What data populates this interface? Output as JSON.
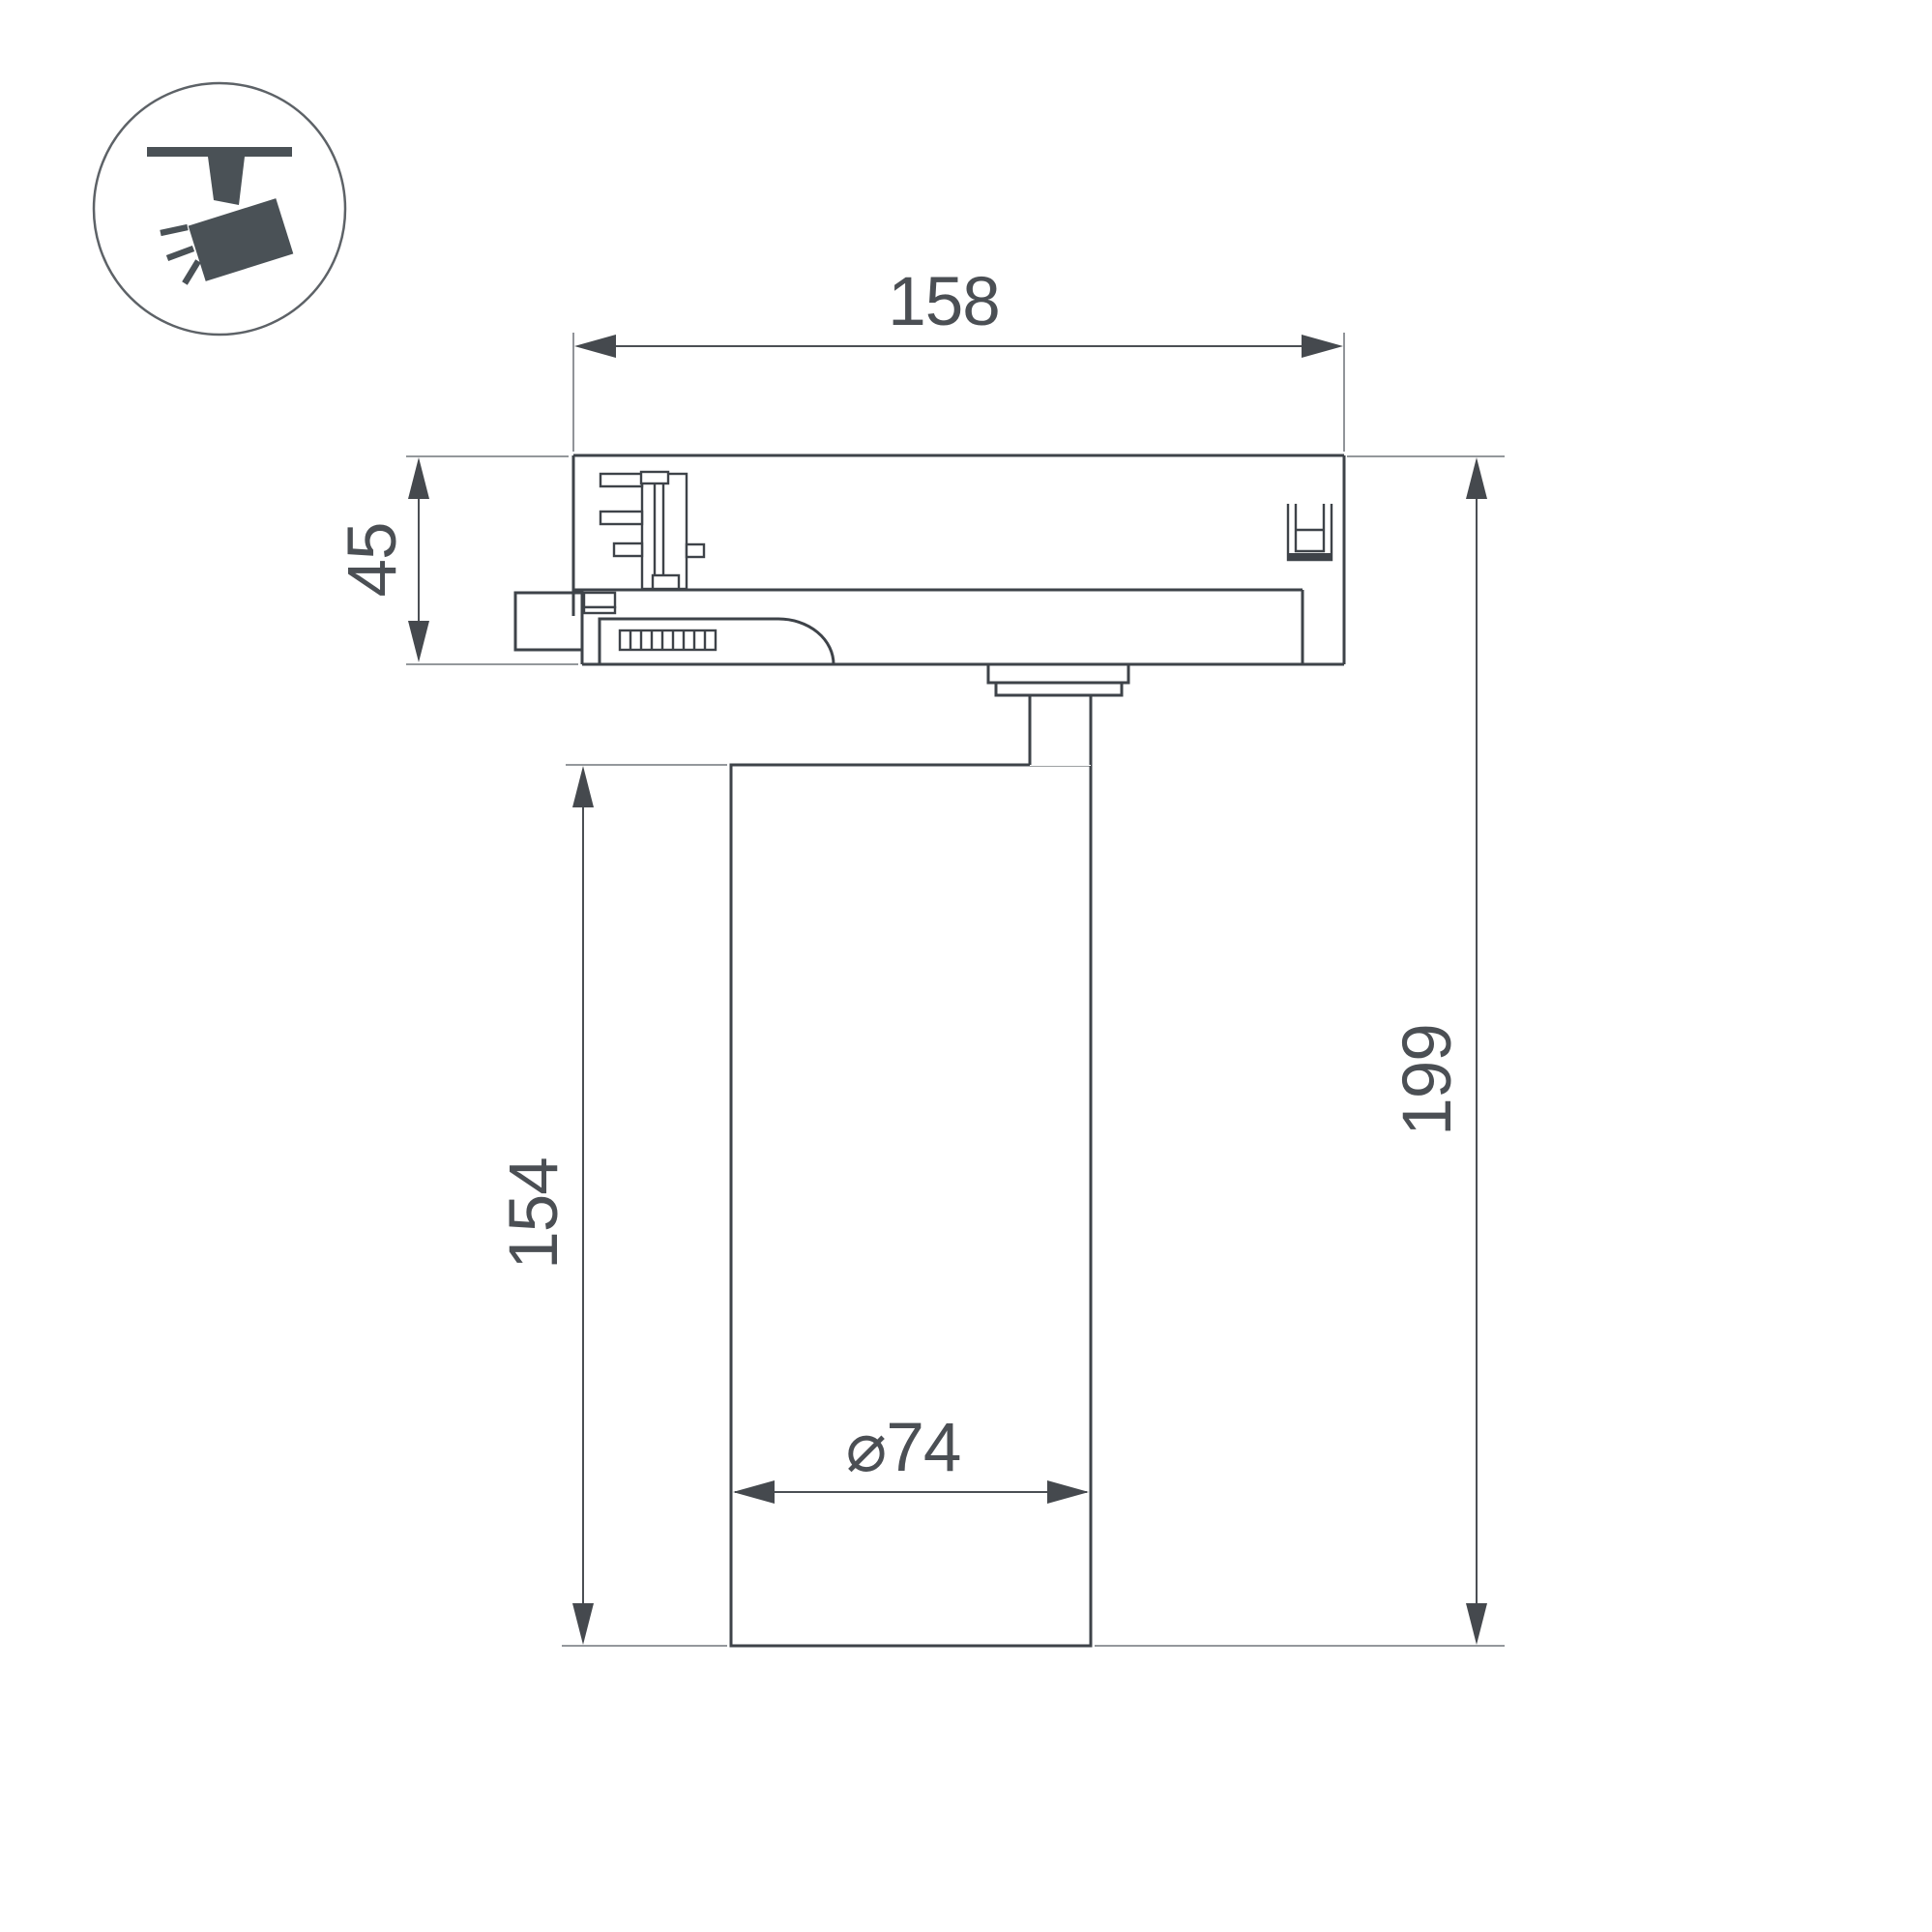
{
  "drawing": {
    "type": "technical-dimension-drawing",
    "subject": "track-mounted spotlight, side view"
  },
  "icon": {
    "name": "track-spotlight",
    "fill_color": "#4a5156",
    "circle_color": "#5d6267"
  },
  "dimensions": {
    "adapter_width": "158",
    "adapter_height": "45",
    "body_height": "154",
    "total_height": "199",
    "body_diameter": "⌀74"
  },
  "colors": {
    "background": "#ffffff",
    "part_outline": "#3e4349",
    "dimension": "#4b4f54",
    "extension_line": "#85898e"
  }
}
